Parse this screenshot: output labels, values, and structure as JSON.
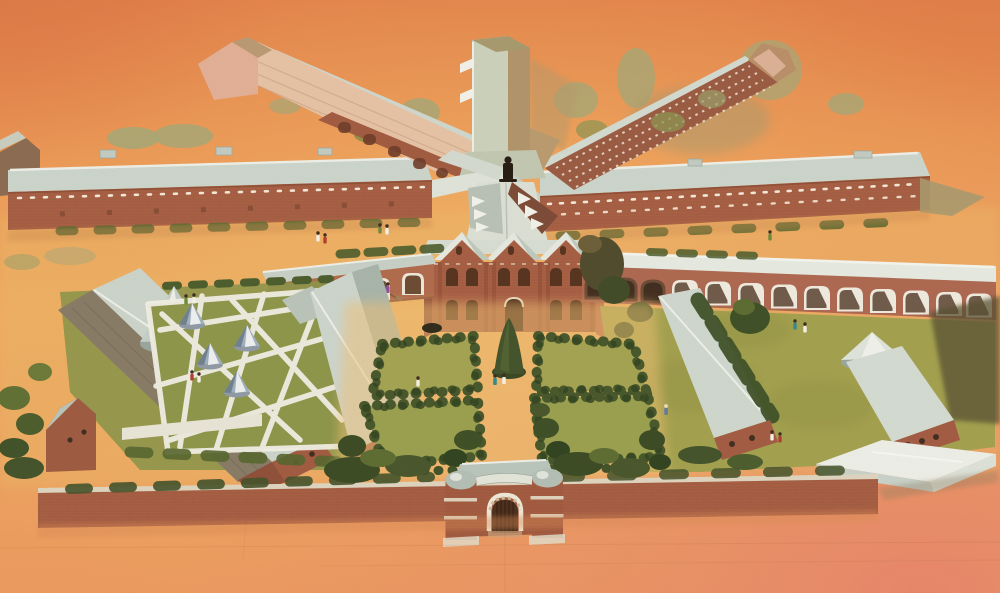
{
  "artwork": {
    "medium": "watercolor",
    "view": "aerial perspective illustration",
    "subject": "Victorian radial-plan prison complex with chapel, cloisters, walled formal garden, airing yards and twin-towered gatehouse"
  },
  "palette": {
    "sky_deep": "#e28049",
    "sky_warm": "#eb9554",
    "sky_light": "#f0ab60",
    "sky_low": "#ec9a5f",
    "glow": "#f4ba6b",
    "salmon": "#e8856a",
    "sand": "#edb967",
    "garden_sand": "#f1c175",
    "roof_pale": "#ccd6cd",
    "roof_white": "#edf0e9",
    "roof_shade": "#a8b5ab",
    "roof_dark": "#877b66",
    "brick": "#a85f44",
    "brick_mid": "#9a5a42",
    "brick_warm": "#ad6750",
    "brick_dark": "#8c4b34",
    "brick_deep": "#70452f",
    "brick_line": "#8a4c33",
    "pink_facade": "#e7c3a6",
    "pink_gable": "#e2b096",
    "tower_face": "#ccd2bd",
    "tower_side": "#b1946a",
    "khaki": "#a89a6e",
    "khaki_tree": "#a8a775",
    "olive": "#6b7a38",
    "hedge": "#45572a",
    "hedge_deep": "#2f421f",
    "lawn": "#a2a14e",
    "yard_grass": "#8c964a",
    "bed_grass": "#a3a352",
    "path_white": "#f2f0e6",
    "tent": "#9fb0bf",
    "tent_shade": "#6f8090",
    "window_dark": "#55321e",
    "door_dark": "#4a2e1c",
    "statue_dark": "#241a10",
    "coping": "#ded5c0",
    "dome": "#b3bfb6",
    "figure_red": "#b23b2f",
    "figure_teal": "#2e8b8b",
    "figure_blue": "#4a6fa5",
    "figure_white": "#f5f2e8",
    "figure_purple": "#8b4f9b"
  },
  "scene": {
    "background": "orange watercolor wash, deeper at top corners, salmon at lower right",
    "radial_prison": {
      "central_tower": "tall grey-green ventilation tower",
      "hub_statue": "small dark figure at hub of radiating roofs",
      "west_range": "long cell block with grey roof and row of white windows",
      "east_range": "long cell block with grey roof and two rows of white windows",
      "northwest_wing": "diagonal wing with pink roof plane and arched openings",
      "northeast_wing": "diagonal wing with gridded white windows"
    },
    "chapel": "three-gabled brick chapel with arched windows and central door",
    "cloisters": {
      "west_arches": 4,
      "east_dark_arches": 3,
      "east_white_arches": 10
    },
    "west_courtyard": {
      "features": [
        "two long grey-roofed ranges",
        "cone-roofed pavilion",
        "airing yard with criss-cross white paths",
        "four conical shelters"
      ]
    },
    "east_courtyard": {
      "features": [
        "green lawn",
        "two brick-gabled ranges",
        "round pavilion roof",
        "white hip-roofed building",
        "strolling figures"
      ]
    },
    "formal_garden": {
      "hedge_beds": 4,
      "features": [
        "central path",
        "conical clipped tree",
        "walking couple"
      ]
    },
    "perimeter": {
      "wall": "long brick boundary wall with light coping",
      "gatehouse": "twin round towers with domed caps, white bands and arched timber door"
    }
  }
}
